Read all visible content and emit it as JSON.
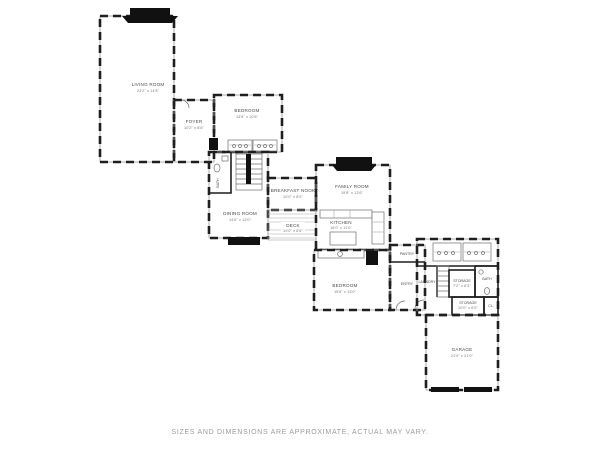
{
  "footer": {
    "disclaimer": "SIZES AND DIMENSIONS ARE APPROXIMATE, ACTUAL MAY VARY."
  },
  "rooms": {
    "living_room": {
      "name": "LIVING ROOM",
      "dims": "24'2\" x 14'8\""
    },
    "foyer": {
      "name": "FOYER",
      "dims": "10'2\" x 8'6\""
    },
    "bedroom_upper": {
      "name": "BEDROOM",
      "dims": "13'8\" x 10'6\""
    },
    "powder_room": {
      "name": "BATH"
    },
    "dining_room": {
      "name": "DINING ROOM",
      "dims": "14'6\" x 13'0\""
    },
    "family_room": {
      "name": "FAMILY ROOM",
      "dims": "19'8\" x 13'6\""
    },
    "breakfast_nook": {
      "name": "BREAKFAST NOOK",
      "dims": "10'0\" x 8'0\""
    },
    "deck": {
      "name": "DECK",
      "dims": "10'0\" x 8'6\""
    },
    "kitchen": {
      "name": "KITCHEN",
      "dims": "16'0\" x 11'0\""
    },
    "bedroom_lower": {
      "name": "BEDROOM",
      "dims": "15'6\" x 13'0\""
    },
    "pantry": {
      "name": "PANTRY"
    },
    "entry": {
      "name": "ENTRY"
    },
    "laundry": {
      "name": "LAUNDRY"
    },
    "storage_upper": {
      "name": "STORAGE",
      "dims": "7'2\" x 6'3\""
    },
    "bath_upper": {
      "name": "BATH"
    },
    "storage_lower": {
      "name": "STORAGE",
      "dims": "10'0\" x 6'0\""
    },
    "closet": {
      "name": "CL."
    },
    "garage": {
      "name": "GARAGE",
      "dims": "21'0\" x 21'0\""
    }
  }
}
